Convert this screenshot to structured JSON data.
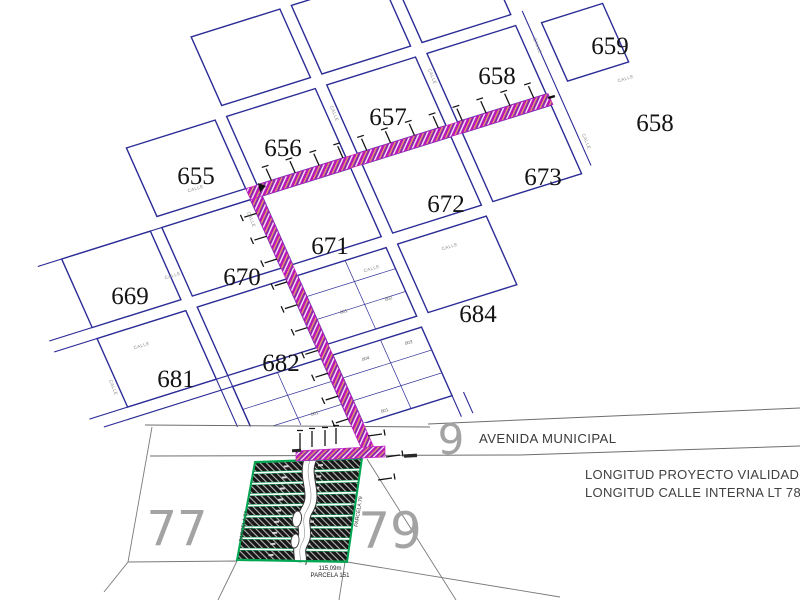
{
  "drawing": {
    "block_labels": [
      "655",
      "656",
      "657",
      "658",
      "659",
      "658",
      "673",
      "672",
      "671",
      "670",
      "669",
      "684",
      "682",
      "681"
    ],
    "sub_lot_labels": [
      "001",
      "002",
      "004",
      "003",
      "001",
      "001"
    ],
    "street_label": "CALLE",
    "avenue": {
      "name": "AVENIDA MUNICIPAL",
      "number": "9"
    },
    "parcels": {
      "left_number": "77",
      "right_number": "79",
      "left_edge_name": "PARCELA 77",
      "left_edge_length": "123,9m",
      "right_edge_name": "PARCELA 79",
      "right_edge_length": "117,09m",
      "bottom_edge_length": "115,09m",
      "bottom_edge_name": "PARCELA 151"
    },
    "notes": [
      "LONGITUD PROYECTO VIALIDAD",
      "LONGITUD CALLE INTERNA LT 78"
    ],
    "colors": {
      "street_line": "#2b2b96",
      "road_highlight": "#b816b8",
      "road_hatch_orange": "#e89b55",
      "parcel_green": "#00a651",
      "numeral_gray": "#a3a3a3"
    }
  }
}
